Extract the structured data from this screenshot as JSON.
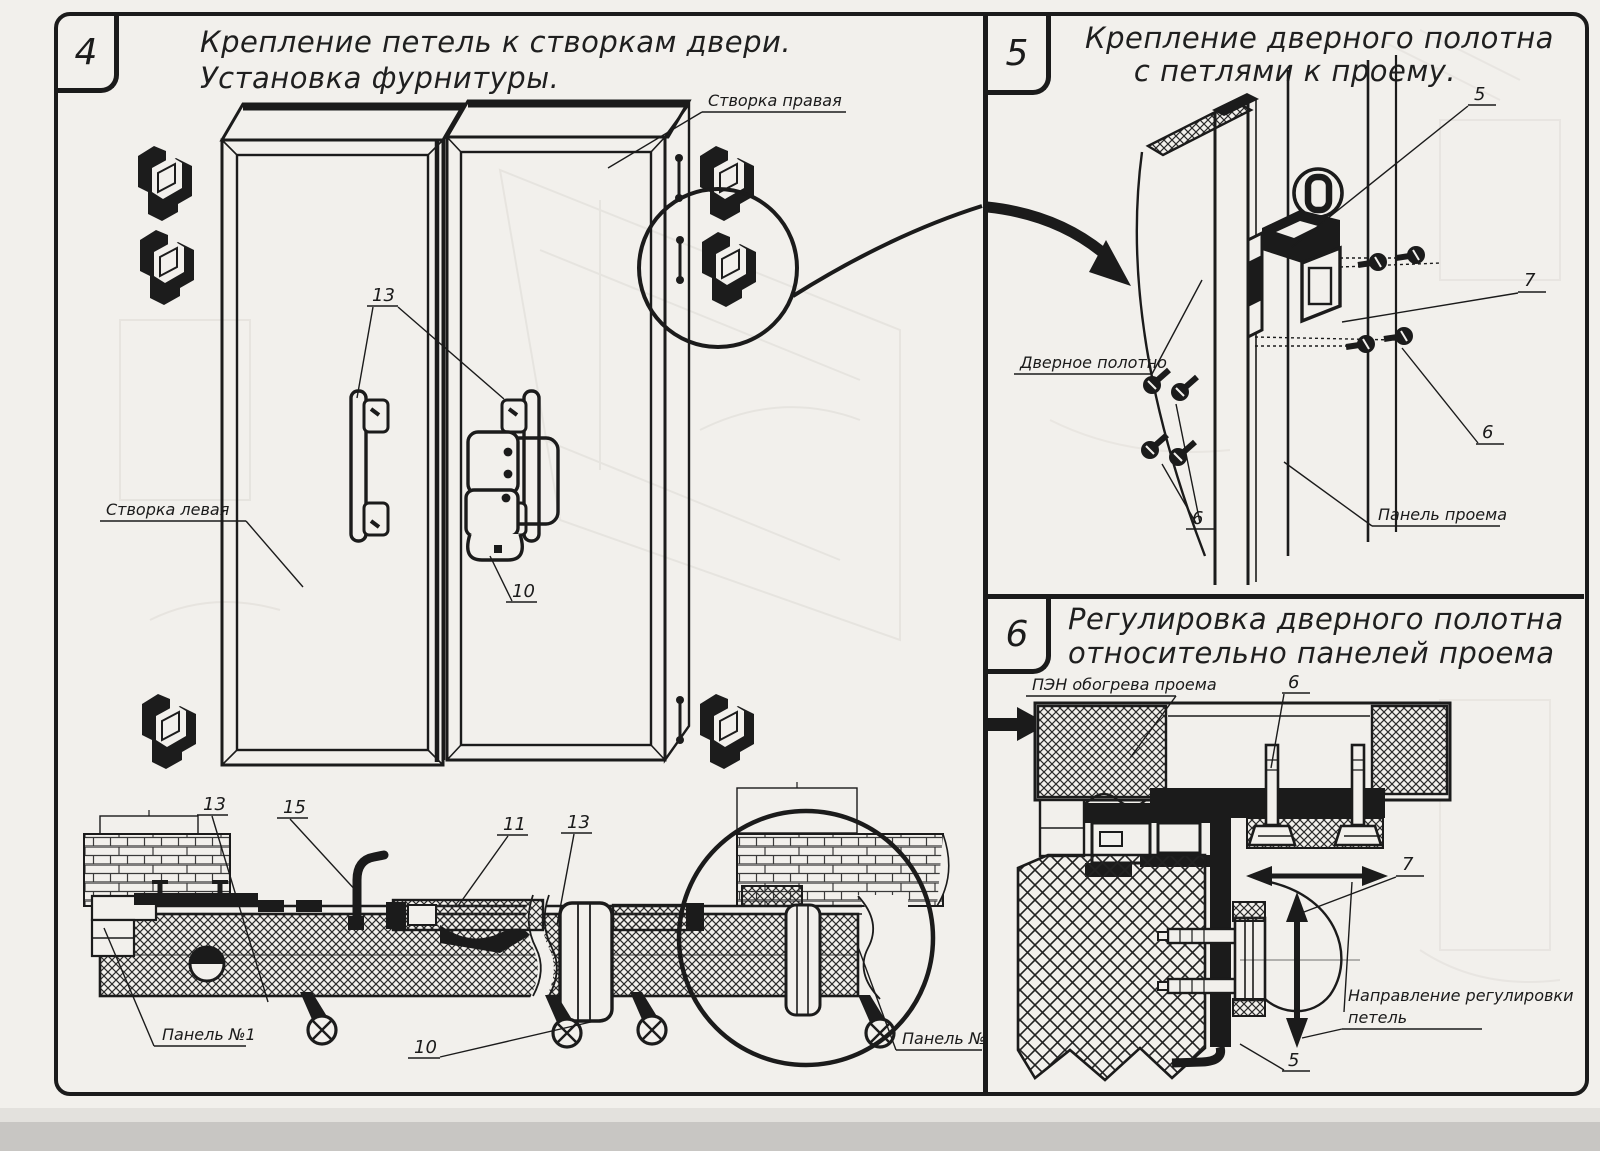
{
  "colors": {
    "ink": "#1b1b1b",
    "paper": "#f2f0ec",
    "scan_strip": "#c8c6c3"
  },
  "panel4": {
    "number": "4",
    "title1": "Крепление петель к створкам двери.",
    "title2": "Установка фурнитуры.",
    "label_right_leaf": "Створка правая",
    "label_left_leaf": "Створка левая",
    "label_panel1": "Панель №1",
    "label_panel2": "Панель №2",
    "callout_13": "13",
    "callout_10": "10",
    "callout_15": "15",
    "callout_11": "11"
  },
  "panel5": {
    "number": "5",
    "title1": "Крепление дверного полотна",
    "title2": "с петлями к проему.",
    "label_door_leaf": "Дверное полотно",
    "label_opening_panel": "Панель проема",
    "callout_5": "5",
    "callout_6": "6",
    "callout_7": "7"
  },
  "panel6": {
    "number": "6",
    "title1": "Регулировка дверного полотна",
    "title2": "относительно панелей проема",
    "label_heater": "ПЭН обогрева проема",
    "label_direction1": "Направление регулировки",
    "label_direction2": "петель",
    "callout_5": "5",
    "callout_6": "6",
    "callout_7": "7"
  }
}
